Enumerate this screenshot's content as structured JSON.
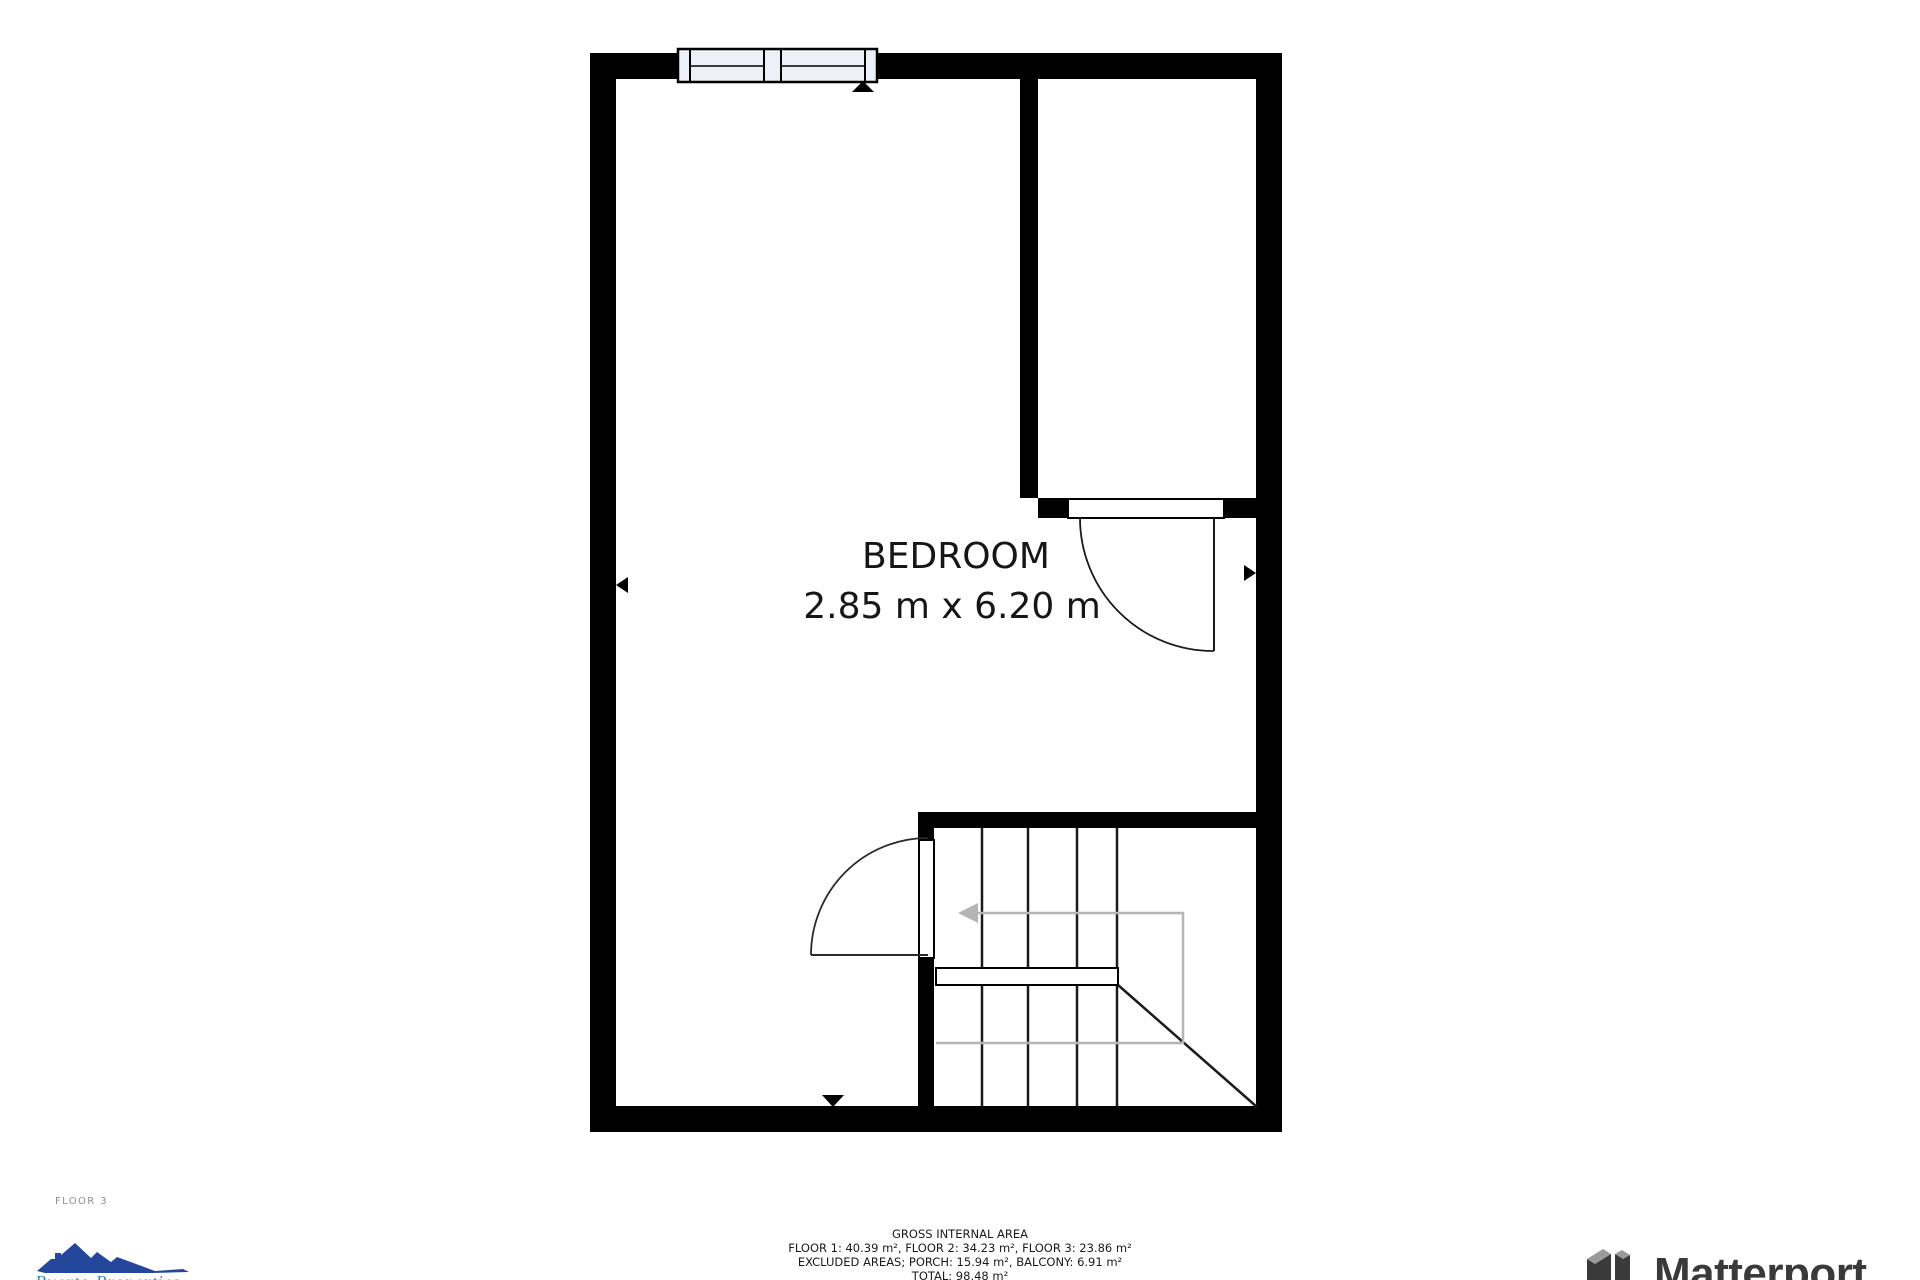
{
  "plan": {
    "room": {
      "label": "BEDROOM",
      "dimensions": "2.85 m x 6.20 m"
    }
  },
  "floor_label": "FLOOR 3",
  "area_summary": {
    "title": "GROSS INTERNAL AREA",
    "floors": "FLOOR 1: 40.39 m², FLOOR 2: 34.23 m², FLOOR 3: 23.86 m²",
    "excluded": "EXCLUDED AREAS; PORCH: 15.94 m², BALCONY: 6.91 m²",
    "total": "TOTAL: 98.48 m²"
  },
  "branding": {
    "agency_name": "Puerto Properties",
    "matterport_name": "Matterport"
  },
  "colors": {
    "wall": "#000000",
    "window_fill": "#eef0f7",
    "walkline_gray": "#b5b5b5",
    "agency_blue": "#25479b",
    "agency_text_blue": "#3d86c6",
    "matterport_gray": "#3a3a3a",
    "matterport_light_gray": "#9a9a9a"
  }
}
